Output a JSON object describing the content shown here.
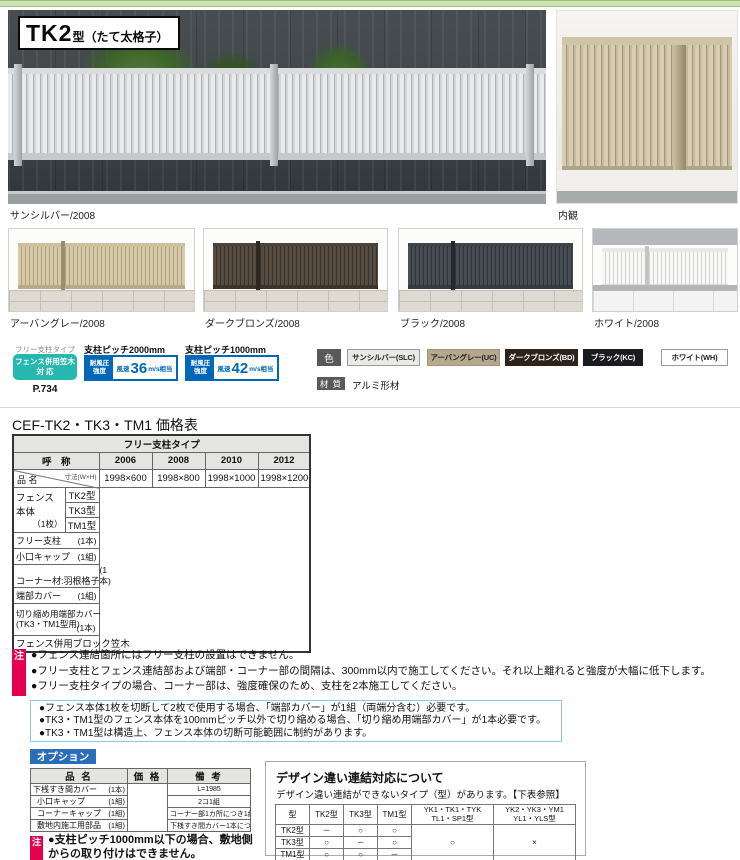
{
  "header": {
    "model": "TK2",
    "model_suffix": "型（たて太格子）"
  },
  "photos": {
    "main_caption": "サンシルバー/2008",
    "inner_caption": "内観",
    "variant_captions": [
      "アーバングレー/2008",
      "ダークブロンズ/2008",
      "ブラック/2008",
      "ホワイト/2008"
    ]
  },
  "spec": {
    "free_post_label": "フリー支柱タイプ",
    "kasagi_badge_line1": "フェンス併用笠木",
    "kasagi_badge_line2": "対 応",
    "page_ref": "P.734",
    "wind_badges": [
      {
        "pitch": "支柱ピッチ2000mm",
        "strength_line1": "耐風圧",
        "strength_line2": "強度",
        "wind_prefix": "風速",
        "wind_value": "36",
        "wind_suffix": "m/s相当"
      },
      {
        "pitch": "支柱ピッチ1000mm",
        "strength_line1": "耐風圧",
        "strength_line2": "強度",
        "wind_prefix": "風速",
        "wind_value": "42",
        "wind_suffix": "m/s相当"
      }
    ],
    "color_label": "色",
    "colors": [
      {
        "name": "サンシルバー(SLC)",
        "bg": "#e9e9e7",
        "fg": "#222222"
      },
      {
        "name": "アーバングレー(UC)",
        "bg": "#b5a88f",
        "fg": "#222222"
      },
      {
        "name": "ダークブロンズ(BD)",
        "bg": "#2e231b",
        "fg": "#ffffff"
      },
      {
        "name": "ブラック(KC)",
        "bg": "#1b1b1d",
        "fg": "#ffffff"
      },
      {
        "name": "ホワイト(WH)",
        "bg": "#fefefe",
        "fg": "#222222"
      }
    ],
    "material_label": "材 質",
    "material_value": "アルミ形材"
  },
  "price_table": {
    "title": "CEF-TK2・TK3・TM1 価格表",
    "top_header": "フリー支柱タイプ",
    "name_header": "呼　称",
    "item_label": "品 名",
    "size_label": "寸法(W×H)",
    "sizes": [
      "2006",
      "2008",
      "2010",
      "2012"
    ],
    "dims": [
      "1998×600",
      "1998×800",
      "1998×1000",
      "1998×1200"
    ],
    "body_label": "フェンス本体",
    "body_unit": "（1枚）",
    "body_types": [
      "TK2型",
      "TK3型",
      "TM1型"
    ],
    "rows": [
      {
        "label": "フリー支柱",
        "unit": "(1本)"
      },
      {
        "label": "小口キャップ",
        "unit": "(1組)"
      },
      {
        "label": "コーナー材:羽根格子",
        "unit": "(1本)"
      },
      {
        "label": "端部カバー",
        "unit": "(1組)"
      }
    ],
    "tall_row": {
      "label": "切り縮め用端部カバー",
      "label2": "(TK3・TM1型用)",
      "unit": "(1本)"
    },
    "kasagi_row": "フェンス併用ブロック笠木"
  },
  "notes_primary": {
    "badge": "注",
    "items": [
      "●フェンス連結箇所にはフリー支柱の設置はできません。",
      "●フリー支柱とフェンス連結部および端部・コーナー部の間隔は、300mm以内で施工してください。それ以上離れると強度が大幅に低下します。",
      "●フリー支柱タイプの場合、コーナー部は、強度確保のため、支柱を2本施工してください。"
    ]
  },
  "notes_secondary": [
    "●フェンス本体1枚を切断して2枚で使用する場合、「端部カバー」が1組（両端分含む）必要です。",
    "●TK3・TM1型のフェンス本体を100mmピッチ以外で切り縮める場合、「切り縮め用端部カバー」が1本必要です。",
    "●TK3・TM1型は構造上、フェンス本体の切断可能範囲に制約があります。"
  ],
  "options": {
    "badge": "オプション",
    "headers": [
      "品 名",
      "価 格",
      "備 考"
    ],
    "rows": [
      {
        "name": "下桟すき間カバー",
        "unit": "(1本)",
        "remark": "L=1985"
      },
      {
        "name": "小口キャップ",
        "unit": "(1組)",
        "remark": "2コ1組"
      },
      {
        "name": "コーナーキャップ",
        "unit": "(1組)",
        "remark": "コーナー部1カ所につき1組必要"
      },
      {
        "name": "敷地内施工用部品",
        "unit": "(1組)",
        "remark": "下桟すき間カバー1本につき1組必要"
      }
    ],
    "note_badge": "注",
    "note": "●支柱ピッチ1000mm以下の場合、敷地側からの取り付けはできません。"
  },
  "design_link": {
    "title": "デザイン違い連結対応について",
    "subtitle": "デザイン違い連結ができないタイプ（型）があります。【下表参照】",
    "col_type": "型",
    "cols": [
      "TK2型",
      "TK3型",
      "TM1型"
    ],
    "col_group1_line1": "YK1・TK1・TYK",
    "col_group1_line2": "TL1・SP1型",
    "col_group2_line1": "YK2・YK3・YM1",
    "col_group2_line2": "YL1・YLS型",
    "rows": [
      {
        "label": "TK2型",
        "cells": [
          "－",
          "○",
          "○"
        ]
      },
      {
        "label": "TK3型",
        "cells": [
          "○",
          "－",
          "○"
        ]
      },
      {
        "label": "TM1型",
        "cells": [
          "○",
          "○",
          "－"
        ]
      }
    ],
    "merged_ok": "○",
    "merged_ng": "×"
  },
  "accent_colors": {
    "teal": "#26b7ae",
    "blue": "#0068b7",
    "pink": "#e5004f",
    "option_blue": "#2a6db8",
    "note_box_border": "#90c8e8",
    "green_bar": "#cfe2b4"
  }
}
